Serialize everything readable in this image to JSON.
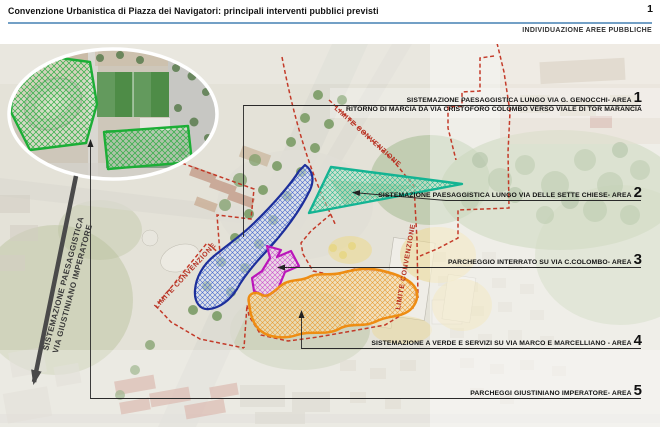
{
  "header": {
    "title": "Convenzione Urbanistica di Piazza dei Navigatori: principali interventi pubblici previsti",
    "page_number": "1",
    "subtitle": "INDIVIDUAZIONE AREE PUBBLICHE"
  },
  "annotations": {
    "area1": {
      "label": "SISTEMAZIONE PAESAGGISTICA LUNGO VIA G. GENOCCHI- AREA",
      "number": "1",
      "sublabel": "RITORNO DI MARCIA DA VIA CRISTOFORO COLOMBO VERSO VIALE DI TOR MARANCIA",
      "zone_color": "#1d2f9b"
    },
    "area2": {
      "label": "SISTEMAZIONE PAESAGGISTICA LUNGO VIA DELLE SETTE CHIESE- AREA",
      "number": "2",
      "zone_color": "#14b493"
    },
    "area3": {
      "label": "PARCHEGGIO INTERRATO SU VIA C.COLOMBO- AREA",
      "number": "3",
      "zone_color": "#ba16ba"
    },
    "area4": {
      "label": "SISTEMAZIONE A VERDE E SERVIZI SU VIA MARCO E MARCELLIANO - AREA",
      "number": "4",
      "zone_color": "#ee8d13"
    },
    "area5": {
      "label": "PARCHEGGI GIUSTINIANO IMPERATORE- AREA",
      "number": "5",
      "zone_color": "#1cae36"
    }
  },
  "map_labels": {
    "limite1": "LIMITE CONVENZIONE",
    "limite2": "LIMITE CONVENZIONE",
    "limite3": "LIMITE CONVENZIONE",
    "giustiniano1": "SISTEMAZIONE PAESAGGISTICA",
    "giustiniano2": "VIA GIUSTINIANO IMPERATORE"
  },
  "colors": {
    "boundary_dashed": "#c23220",
    "header_rule": "#73a0c6",
    "limite_text": "#b53022"
  }
}
